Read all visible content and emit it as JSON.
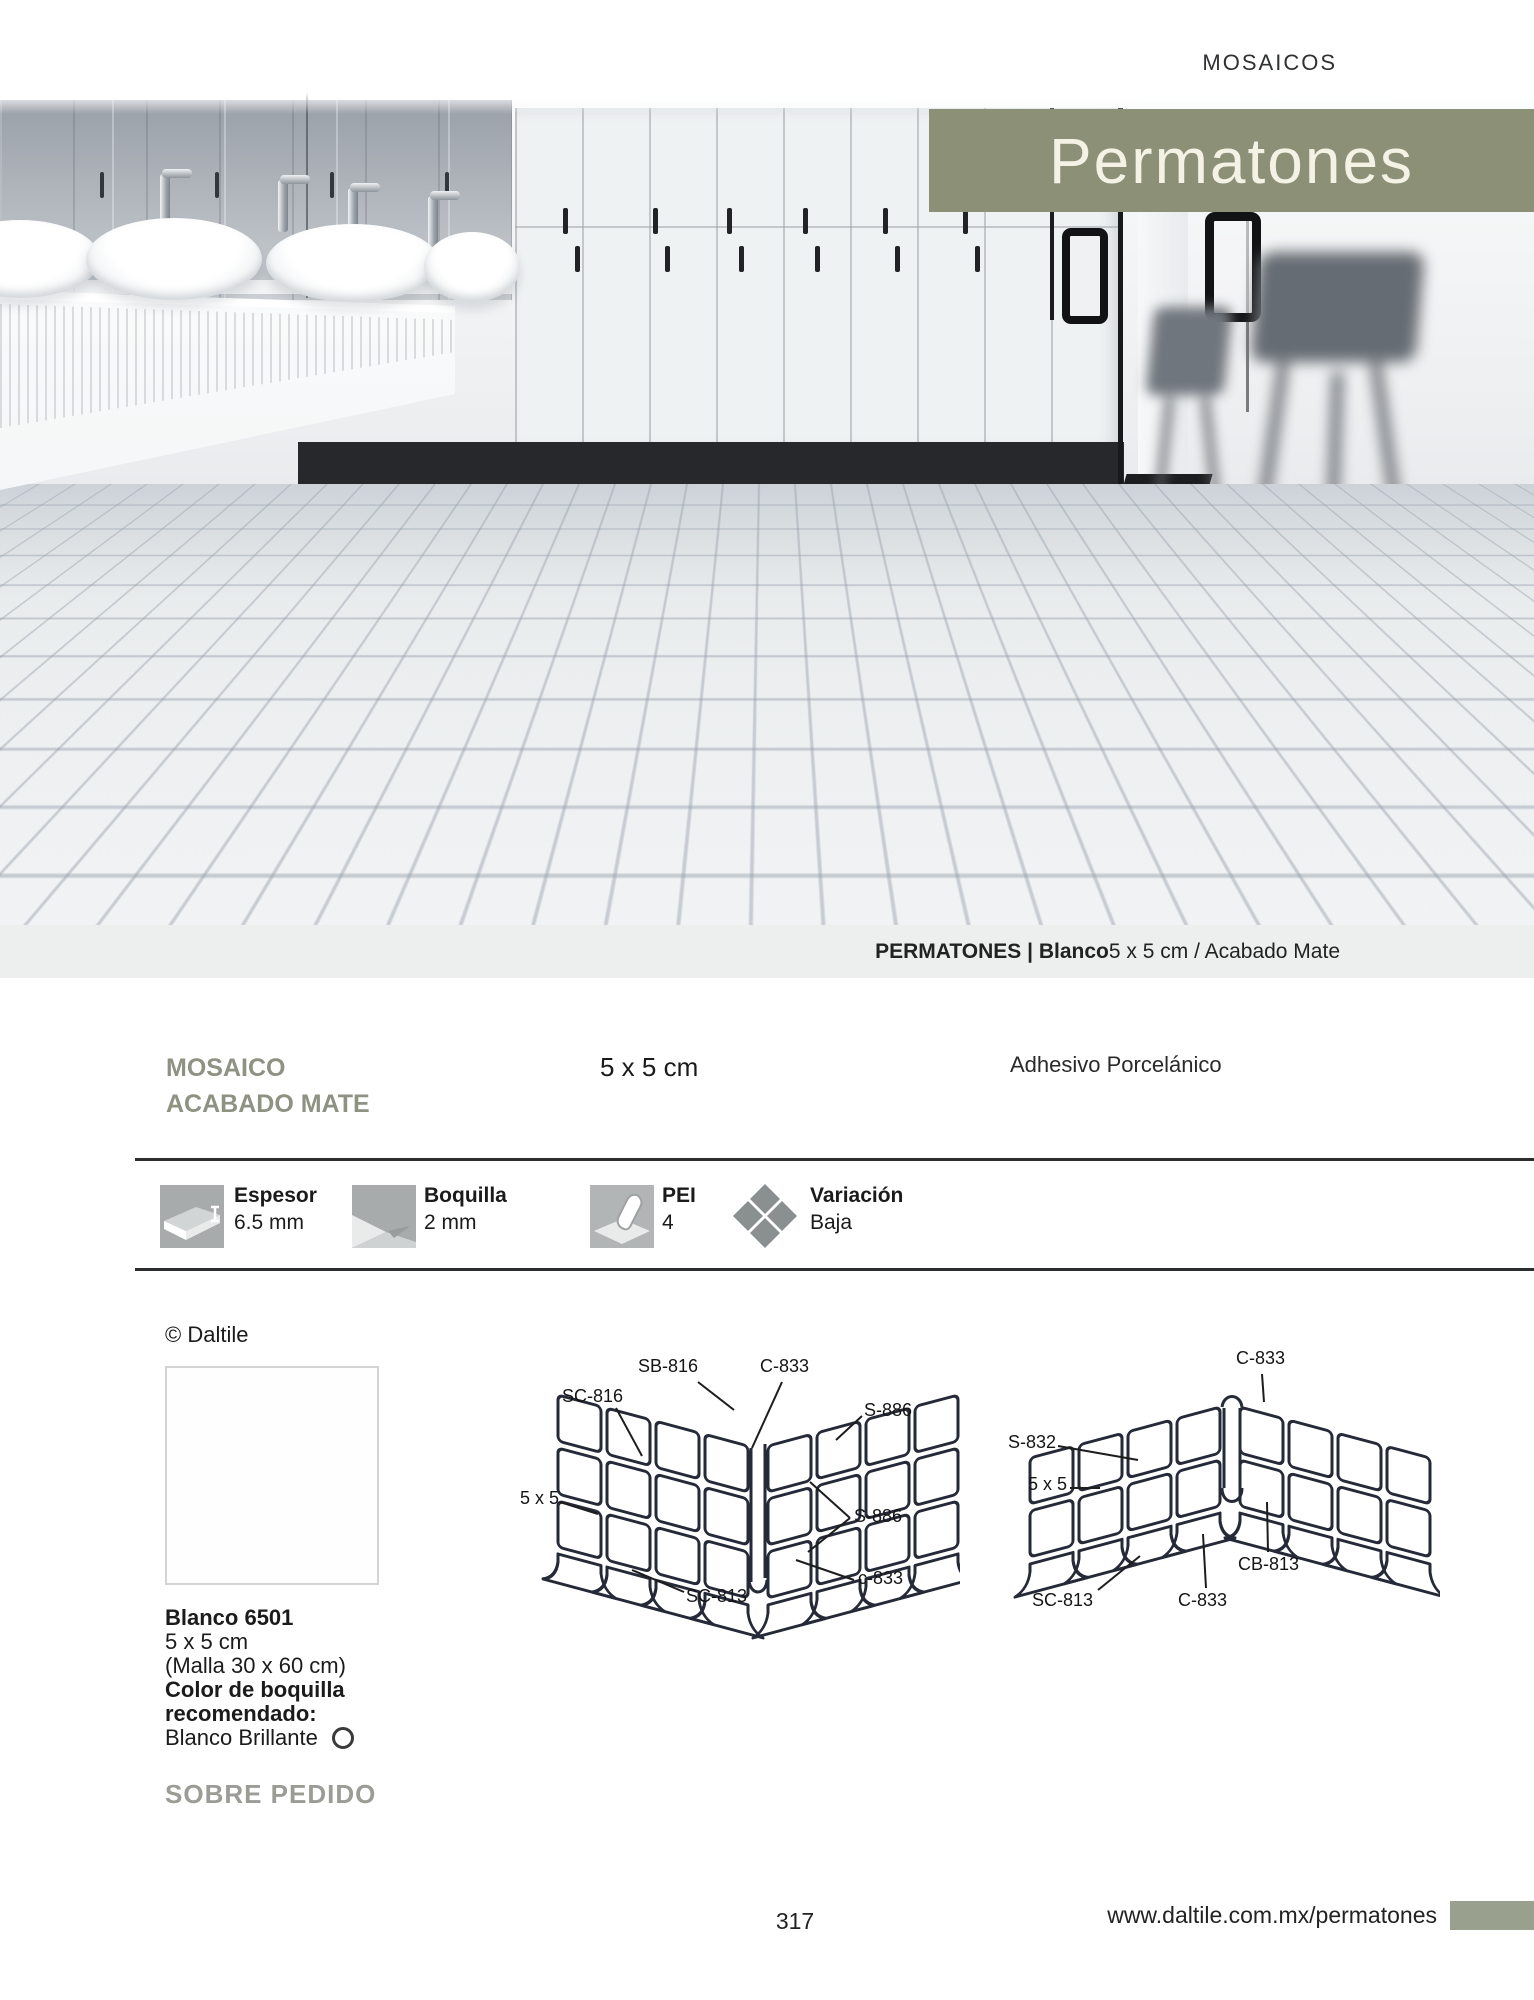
{
  "colors": {
    "accent": "#8b9077",
    "tab": "#99a08d",
    "heading_gray": "#8e9283",
    "muted_gray": "#9c9c97"
  },
  "header": {
    "section_label": "MOSAICOS"
  },
  "hero": {
    "title": "Permatones",
    "caption_bold": "PERMATONES | Blanco",
    "caption_rest": " 5 x 5 cm / Acabado Mate"
  },
  "intro": {
    "line1": "MOSAICO",
    "line2": "ACABADO MATE",
    "size": "5 x 5 cm",
    "adhesive": "Adhesivo Porcelánico"
  },
  "specs": [
    {
      "name": "espesor",
      "label": "Espesor",
      "value": "6.5 mm"
    },
    {
      "name": "boquilla",
      "label": "Boquilla",
      "value": "2 mm"
    },
    {
      "name": "pei",
      "label": "PEI",
      "value": "4"
    },
    {
      "name": "variacion",
      "label": "Variación",
      "value": "Baja"
    }
  ],
  "product": {
    "copyright": "© Daltile",
    "name": "Blanco 6501",
    "size": "5 x 5 cm",
    "mesh": "(Malla 30 x 60 cm)",
    "grout_label_1": "Color de boquilla",
    "grout_label_2": "recomendado:",
    "grout_value": "Blanco Brillante",
    "availability": "SOBRE PEDIDO"
  },
  "diagram_inside_corner": {
    "labels": {
      "sb816": "SB-816",
      "c833_top": "C-833",
      "sc816": "SC-816",
      "s886_top": "S-886",
      "size": "5 x 5",
      "s886_right": "S-886",
      "c833_bottom": "c-833",
      "sc813": "SC-813"
    }
  },
  "diagram_outside_corner": {
    "labels": {
      "c833_top": "C-833",
      "s832": "S-832",
      "size": "5 x 5",
      "cb813": "CB-813",
      "sc813": "SC-813",
      "c833_bottom": "C-833"
    }
  },
  "footer": {
    "page_number": "317",
    "url": "www.daltile.com.mx/permatones"
  }
}
